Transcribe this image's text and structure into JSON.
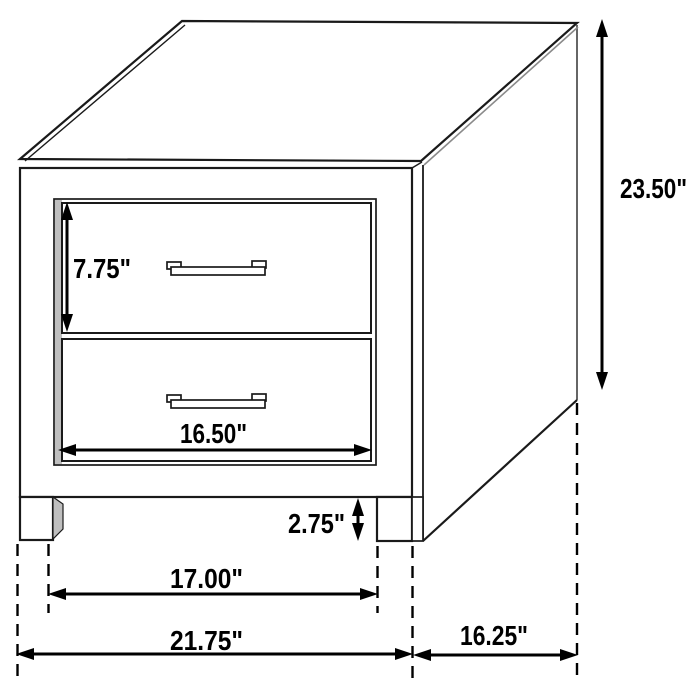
{
  "diagram": {
    "background": "#ffffff",
    "line_color": "#1a1a1a",
    "dimension_color": "#000000",
    "shade_color": "#bfbfbf",
    "unit": "inches",
    "labels": {
      "total_height": "23.50\"",
      "top_drawer_height": "7.75\"",
      "drawer_width": "16.50\"",
      "base_clearance": "2.75\"",
      "inner_leg_width": "17.00\"",
      "total_width": "21.75\"",
      "depth": "16.25\""
    }
  }
}
